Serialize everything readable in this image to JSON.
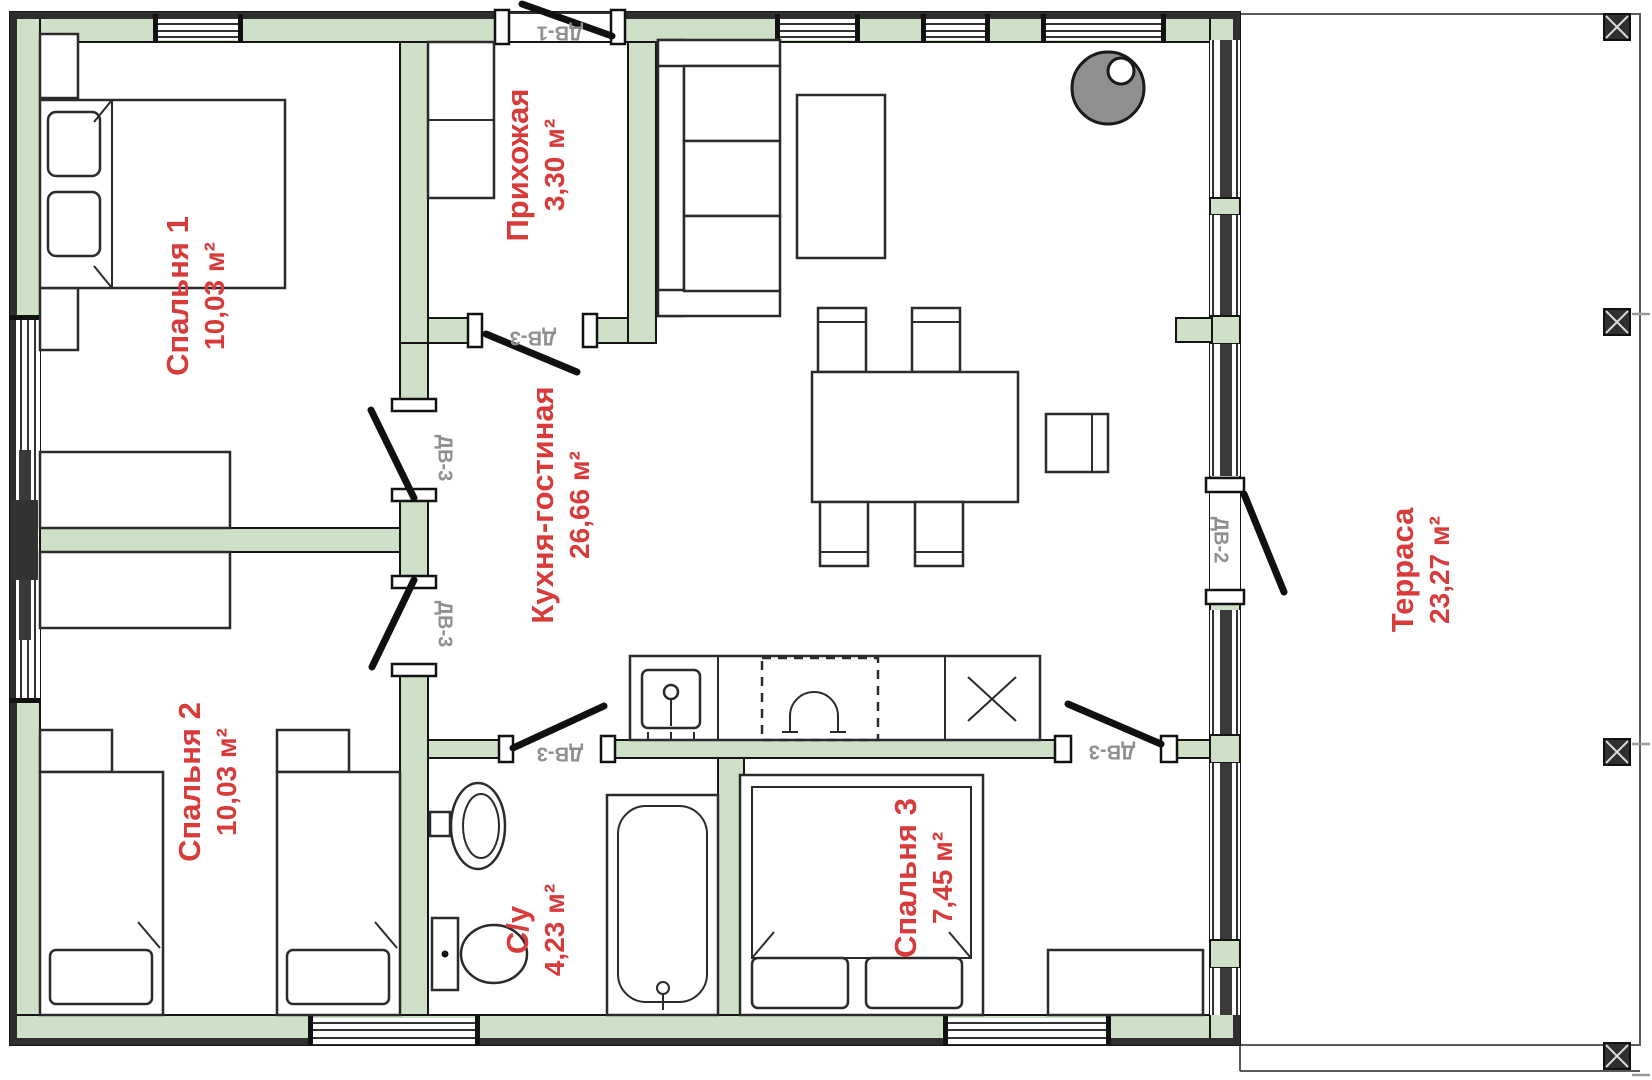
{
  "rooms": {
    "bedroom1": {
      "name": "Спальня 1",
      "area": "10,03 м²"
    },
    "hallway": {
      "name": "Прихожая",
      "area": "3,30 м²"
    },
    "kitchen_living": {
      "name": "Кухня-гостиная",
      "area": "26,66 м²"
    },
    "bedroom2": {
      "name": "Спальня 2",
      "area": "10,03 м²"
    },
    "bathroom": {
      "name": "С/у",
      "area": "4,23 м²"
    },
    "bedroom3": {
      "name": "Спальня 3",
      "area": "7,45 м²"
    },
    "terrace": {
      "name": "Терраса",
      "area": "23,27 м²"
    }
  },
  "doors": {
    "entry": {
      "label": "ДВ-1"
    },
    "terrace": {
      "label": "ДВ-2"
    },
    "hallway_kitchen": {
      "label": "ДВ-3"
    },
    "bedroom1": {
      "label": "ДВ-3"
    },
    "bedroom2": {
      "label": "ДВ-3"
    },
    "bathroom": {
      "label": "ДВ-3"
    },
    "bedroom3": {
      "label": "ДВ-3"
    }
  },
  "colors": {
    "wall_fill": "#cfe0c8",
    "wall_stroke": "#151515",
    "outer_band": "#2e2e2e",
    "room_label": "#d93a3a",
    "door_label": "#8f8f8f",
    "stove_fill": "#8f8f8f",
    "furniture_stroke": "#2b2b2b"
  }
}
